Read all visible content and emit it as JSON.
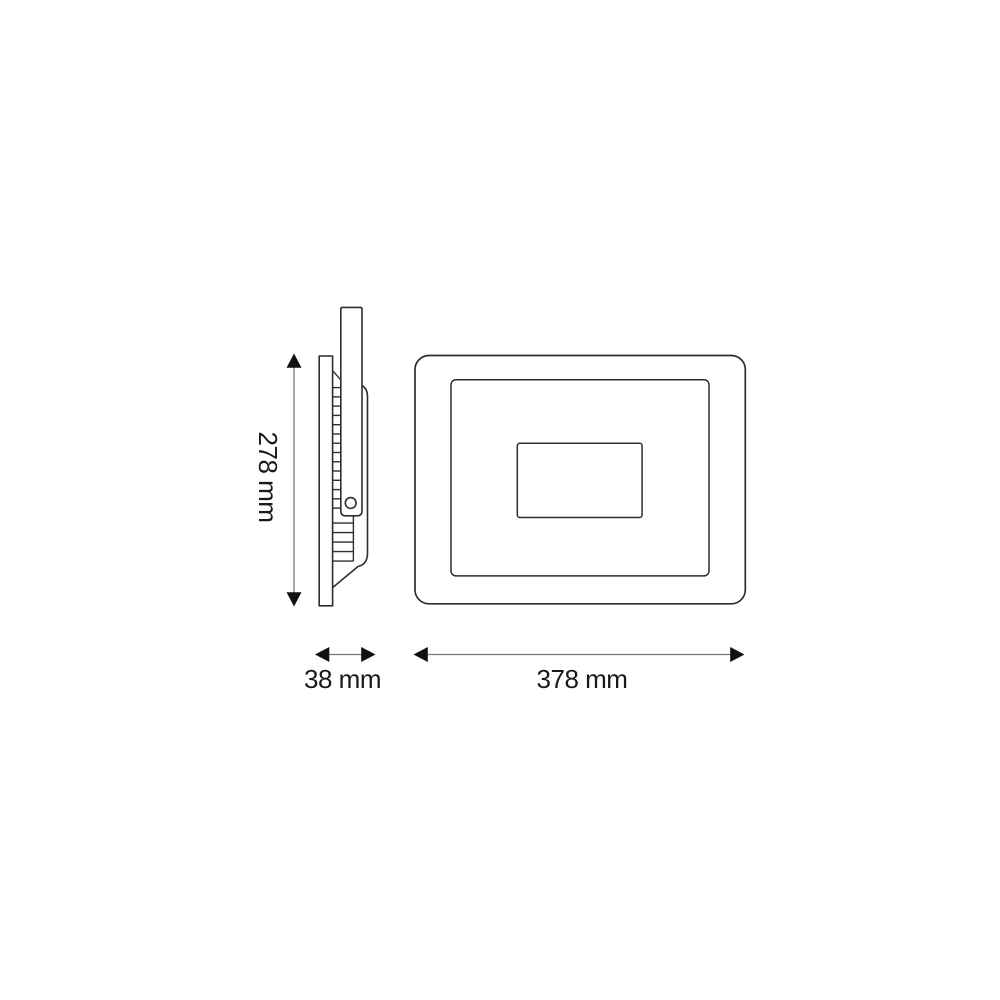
{
  "diagram": {
    "views": {
      "side_view": "side profile with heatsink fins and mounting bracket",
      "front_view": "front face with nested frame and driver box"
    },
    "dimensions": {
      "height": {
        "label": "278 mm",
        "value": 278,
        "unit": "mm"
      },
      "depth": {
        "label": "38 mm",
        "value": 38,
        "unit": "mm"
      },
      "width": {
        "label": "378 mm",
        "value": 378,
        "unit": "mm"
      }
    },
    "colors": {
      "background": "#ffffff",
      "outline": "#2e2e2e",
      "dimension_line": "#7a7a7a",
      "arrowhead": "#111111",
      "text": "#1a1a1a"
    }
  }
}
